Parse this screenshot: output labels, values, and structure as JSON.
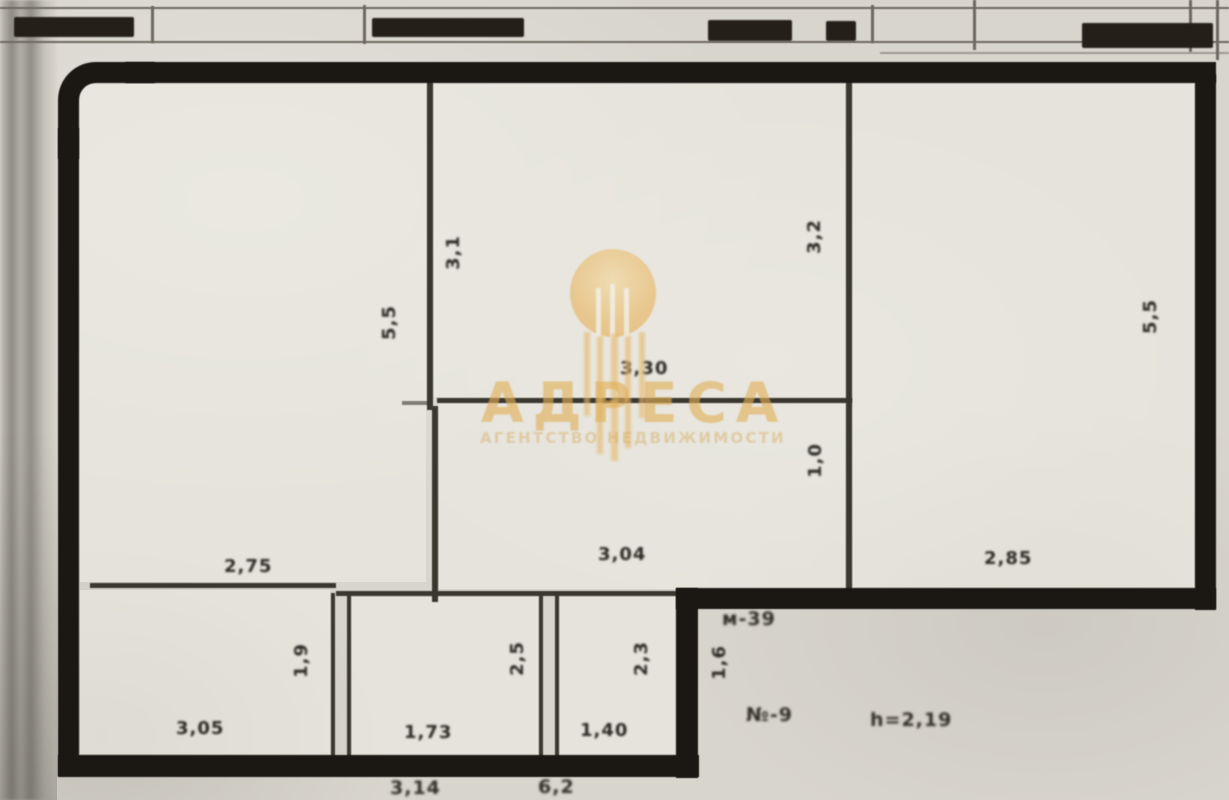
{
  "watermark": {
    "brand": "АДРЕСА",
    "tagline": "АГЕНТСТВО НЕДВИЖИМОСТИ",
    "gold": "#e0ae56"
  },
  "plan": {
    "paper_color": "#d8d5cd",
    "wall_color": "#1b1814",
    "rooms": {
      "top_left": {
        "height_label": "5,5",
        "width_label": "2,75"
      },
      "top_middle": {
        "height_label": "3,1",
        "width_label": "3,30"
      },
      "mid_center": {
        "height_label": "1,0",
        "width_label": "3,04"
      },
      "right": {
        "height_label_left": "3,2",
        "height_label_right": "5,5",
        "width_label": "2,85"
      },
      "bottom_left": {
        "height_label": "1,9",
        "width_label": "3,05"
      },
      "bottom_middle": {
        "height_label": "2,5",
        "width_label": "1,73"
      },
      "bottom_right": {
        "height_label": "2,3",
        "width_label": "1,40"
      },
      "step_niche": {
        "height_label": "1,6"
      }
    },
    "notes": {
      "room_mark": "м-39",
      "apt_mark": "№-9",
      "ceiling_height": "h=2,19",
      "edge_note_1": "3,14",
      "edge_note_2": "6,2"
    }
  }
}
